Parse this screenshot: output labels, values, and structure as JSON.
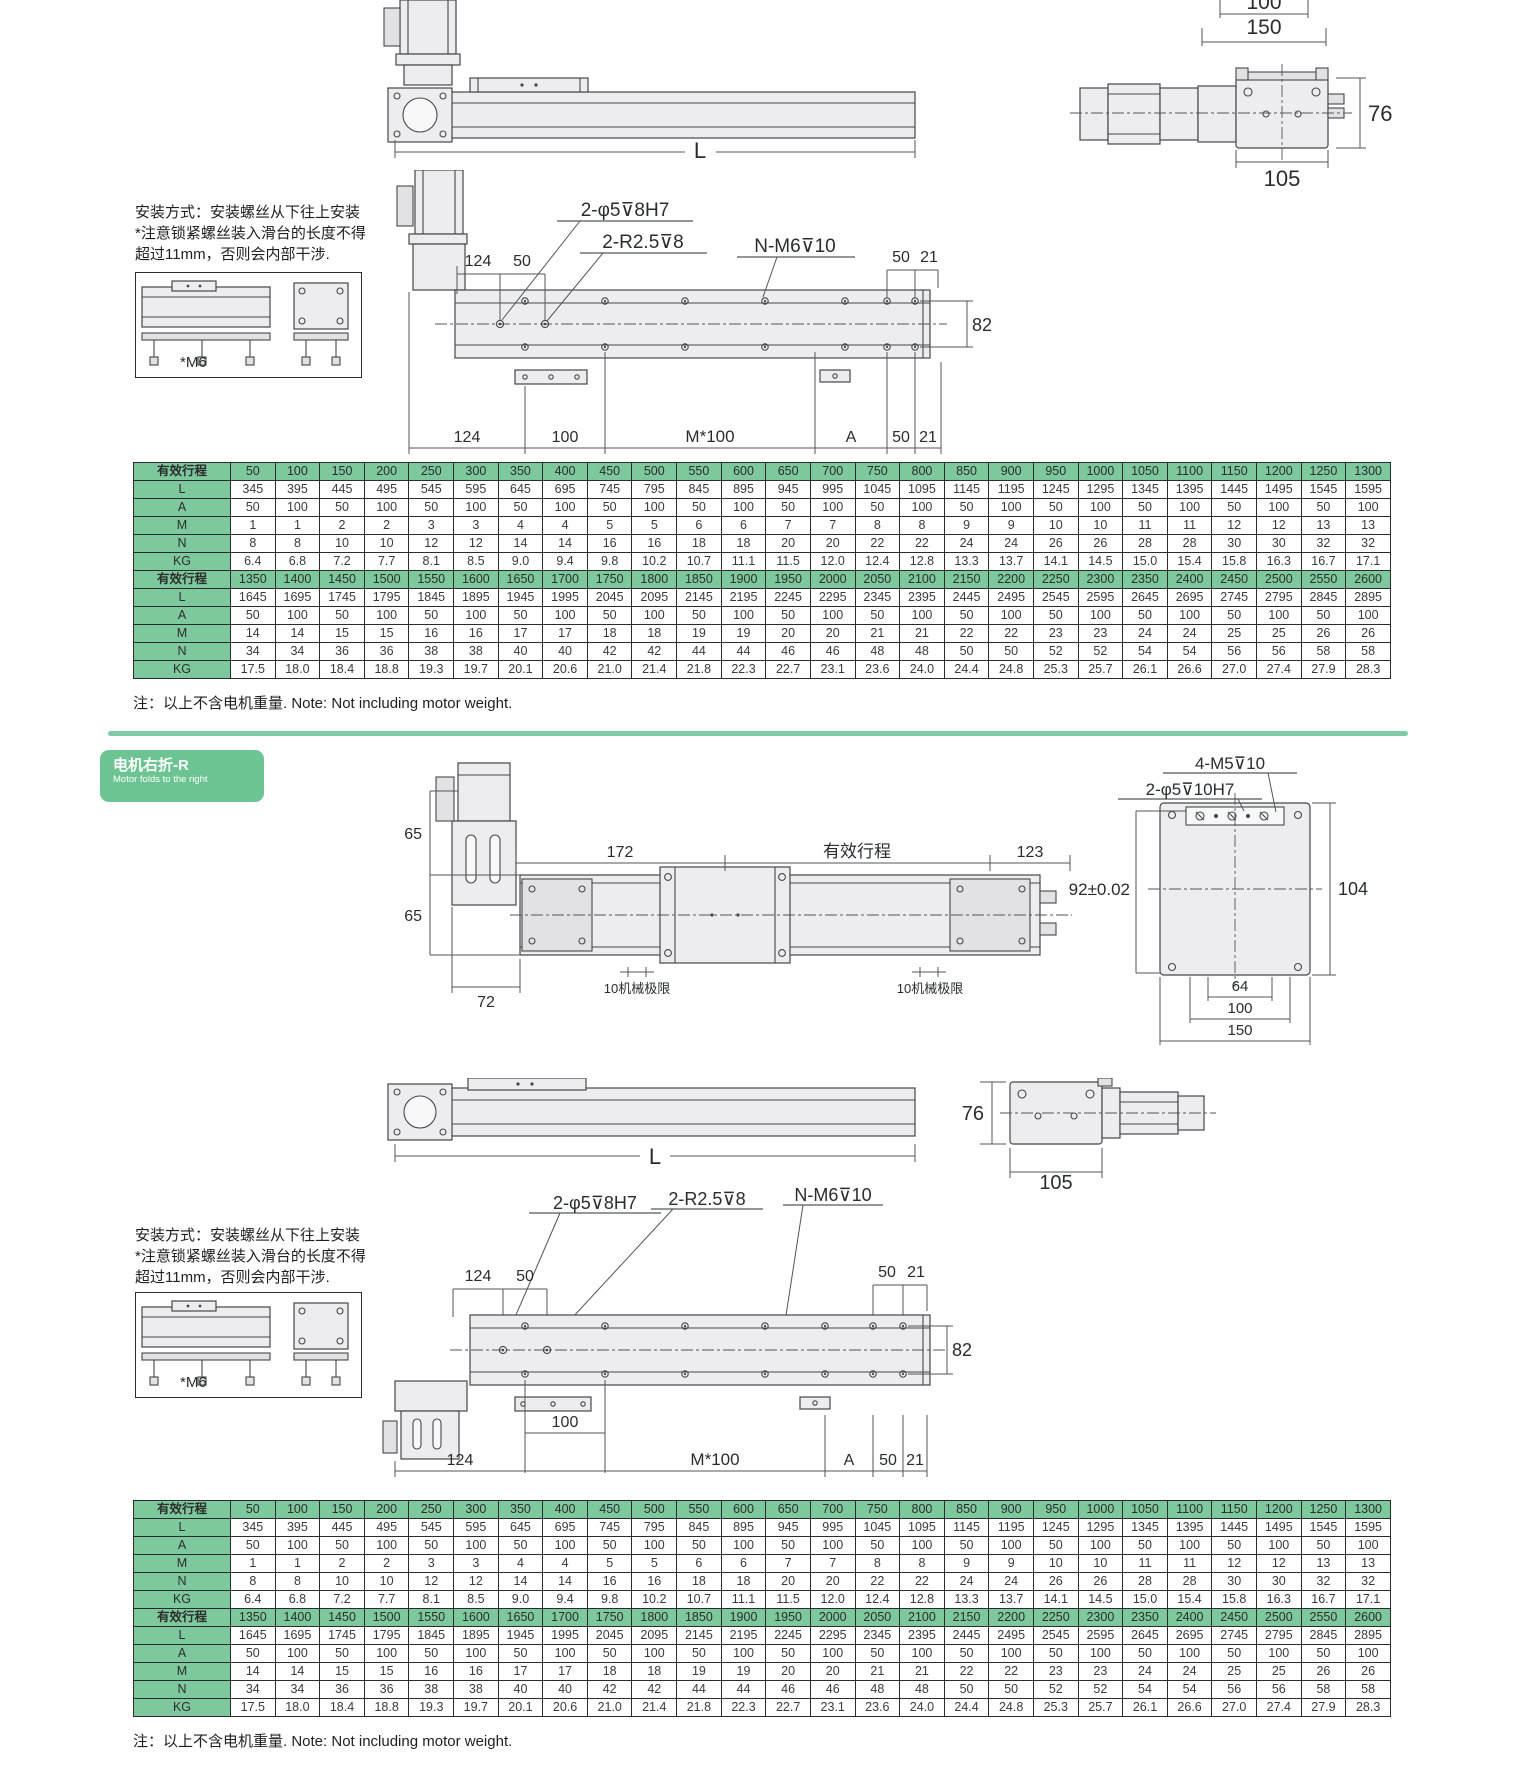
{
  "colors": {
    "table_header_green": "#7dc89d",
    "section_label_green": "#6cc492",
    "divider_green": "#7fcba1",
    "drawing_line": "#46474b"
  },
  "section_label": {
    "title": "电机右折-R",
    "subtitle": "Motor folds to the right"
  },
  "install_note": {
    "line1": "安装方式：安装螺丝从下往上安装",
    "line2": "*注意锁紧螺丝装入滑台的长度不得",
    "line3": "超过11mm，否则会内部干涉.",
    "m6_label": "*M6"
  },
  "footnote": "注：以上不含电机重量. Note: Not including motor weight.",
  "drawings": {
    "top_side_view": {
      "length_label": "L"
    },
    "top_end_view": {
      "d100": "100",
      "d150": "150",
      "d76": "76",
      "d105": "105"
    },
    "bottom_view": {
      "callout_pin": "2-φ5⊽8H7",
      "callout_radius": "2-R2.5⊽8",
      "callout_thread": "N-M6⊽10",
      "d124": "124",
      "d50": "50",
      "d50r": "50",
      "d21r": "21",
      "d82": "82",
      "b124": "124",
      "b100": "100",
      "bM100": "M*100",
      "bA": "A",
      "b50": "50",
      "b21": "21"
    },
    "right_fold_top_view": {
      "d65a": "65",
      "d65b": "65",
      "d172": "172",
      "stroke_label": "有效行程",
      "d123": "123",
      "d72": "72",
      "mech_limit_left": "10机械极限",
      "mech_limit_right": "10机械极限"
    },
    "flange_view": {
      "callout_m5": "4-M5⊽10",
      "callout_pin": "2-φ5⊽10H7",
      "d92": "92±0.02",
      "d104": "104",
      "d64": "64",
      "d100": "100",
      "d150": "150"
    },
    "side_view2": {
      "length_label": "L",
      "d76": "76",
      "d105": "105"
    }
  },
  "table": {
    "header_label": "有效行程",
    "row_labels": [
      "L",
      "A",
      "M",
      "N",
      "KG"
    ],
    "sections": [
      {
        "strokes": [
          "50",
          "100",
          "150",
          "200",
          "250",
          "300",
          "350",
          "400",
          "450",
          "500",
          "550",
          "600",
          "650",
          "700",
          "750",
          "800",
          "850",
          "900",
          "950",
          "1000",
          "1050",
          "1100",
          "1150",
          "1200",
          "1250",
          "1300"
        ],
        "rows": [
          [
            "345",
            "395",
            "445",
            "495",
            "545",
            "595",
            "645",
            "695",
            "745",
            "795",
            "845",
            "895",
            "945",
            "995",
            "1045",
            "1095",
            "1145",
            "1195",
            "1245",
            "1295",
            "1345",
            "1395",
            "1445",
            "1495",
            "1545",
            "1595"
          ],
          [
            "50",
            "100",
            "50",
            "100",
            "50",
            "100",
            "50",
            "100",
            "50",
            "100",
            "50",
            "100",
            "50",
            "100",
            "50",
            "100",
            "50",
            "100",
            "50",
            "100",
            "50",
            "100",
            "50",
            "100",
            "50",
            "100"
          ],
          [
            "1",
            "1",
            "2",
            "2",
            "3",
            "3",
            "4",
            "4",
            "5",
            "5",
            "6",
            "6",
            "7",
            "7",
            "8",
            "8",
            "9",
            "9",
            "10",
            "10",
            "11",
            "11",
            "12",
            "12",
            "13",
            "13"
          ],
          [
            "8",
            "8",
            "10",
            "10",
            "12",
            "12",
            "14",
            "14",
            "16",
            "16",
            "18",
            "18",
            "20",
            "20",
            "22",
            "22",
            "24",
            "24",
            "26",
            "26",
            "28",
            "28",
            "30",
            "30",
            "32",
            "32"
          ],
          [
            "6.4",
            "6.8",
            "7.2",
            "7.7",
            "8.1",
            "8.5",
            "9.0",
            "9.4",
            "9.8",
            "10.2",
            "10.7",
            "11.1",
            "11.5",
            "12.0",
            "12.4",
            "12.8",
            "13.3",
            "13.7",
            "14.1",
            "14.5",
            "15.0",
            "15.4",
            "15.8",
            "16.3",
            "16.7",
            "17.1"
          ]
        ]
      },
      {
        "strokes": [
          "1350",
          "1400",
          "1450",
          "1500",
          "1550",
          "1600",
          "1650",
          "1700",
          "1750",
          "1800",
          "1850",
          "1900",
          "1950",
          "2000",
          "2050",
          "2100",
          "2150",
          "2200",
          "2250",
          "2300",
          "2350",
          "2400",
          "2450",
          "2500",
          "2550",
          "2600"
        ],
        "rows": [
          [
            "1645",
            "1695",
            "1745",
            "1795",
            "1845",
            "1895",
            "1945",
            "1995",
            "2045",
            "2095",
            "2145",
            "2195",
            "2245",
            "2295",
            "2345",
            "2395",
            "2445",
            "2495",
            "2545",
            "2595",
            "2645",
            "2695",
            "2745",
            "2795",
            "2845",
            "2895"
          ],
          [
            "50",
            "100",
            "50",
            "100",
            "50",
            "100",
            "50",
            "100",
            "50",
            "100",
            "50",
            "100",
            "50",
            "100",
            "50",
            "100",
            "50",
            "100",
            "50",
            "100",
            "50",
            "100",
            "50",
            "100",
            "50",
            "100"
          ],
          [
            "14",
            "14",
            "15",
            "15",
            "16",
            "16",
            "17",
            "17",
            "18",
            "18",
            "19",
            "19",
            "20",
            "20",
            "21",
            "21",
            "22",
            "22",
            "23",
            "23",
            "24",
            "24",
            "25",
            "25",
            "26",
            "26"
          ],
          [
            "34",
            "34",
            "36",
            "36",
            "38",
            "38",
            "40",
            "40",
            "42",
            "42",
            "44",
            "44",
            "46",
            "46",
            "48",
            "48",
            "50",
            "50",
            "52",
            "52",
            "54",
            "54",
            "56",
            "56",
            "58",
            "58"
          ],
          [
            "17.5",
            "18.0",
            "18.4",
            "18.8",
            "19.3",
            "19.7",
            "20.1",
            "20.6",
            "21.0",
            "21.4",
            "21.8",
            "22.3",
            "22.7",
            "23.1",
            "23.6",
            "24.0",
            "24.4",
            "24.8",
            "25.3",
            "25.7",
            "26.1",
            "26.6",
            "27.0",
            "27.4",
            "27.9",
            "28.3"
          ]
        ]
      }
    ]
  }
}
